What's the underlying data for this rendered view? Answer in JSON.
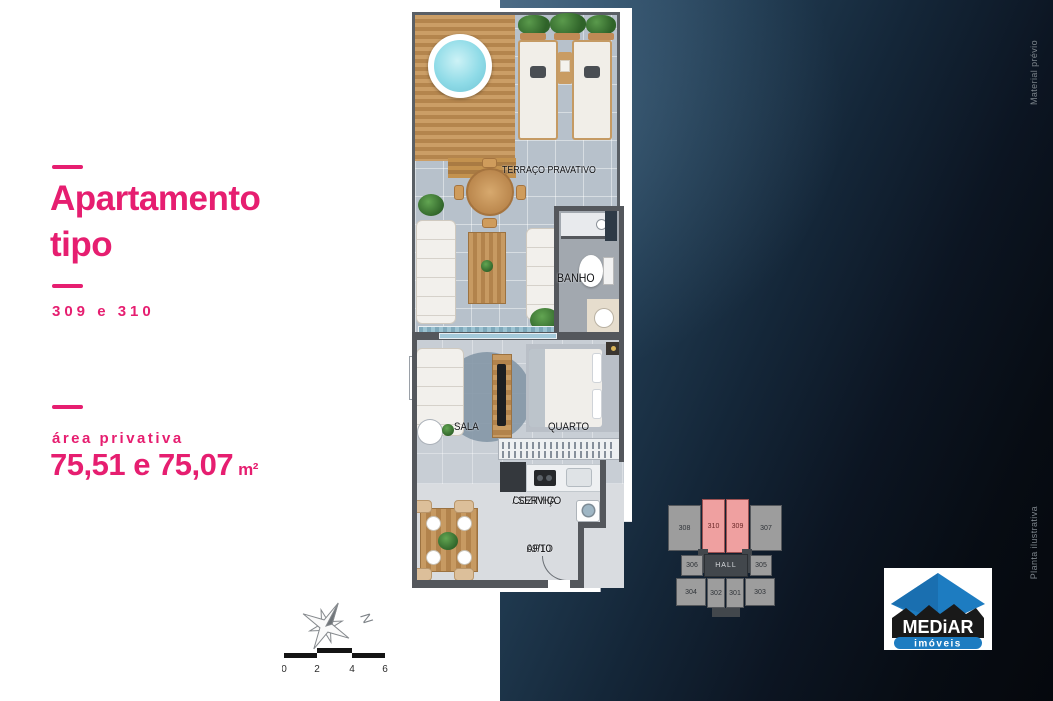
{
  "colors": {
    "accent_pink": "#e61e70",
    "dark_panel_from": "#44627c",
    "dark_panel_to": "#05080d",
    "keyplan_highlight": "#efa0a0",
    "logo_blue": "#1d7cc1"
  },
  "left_panel": {
    "title_line1": "Apartamento",
    "title_line2": "tipo",
    "units_label": "309 e 310",
    "area_label": "área privativa",
    "area_value": "75,51 e 75,07",
    "area_unit": "m²"
  },
  "floor_plan": {
    "labels": {
      "terrace": "TERRAÇO PRAVATIVO",
      "bath": "BANHO",
      "living": "SALA",
      "bedroom": "QUARTO",
      "kitchen_line1": "COZINHA",
      "kitchen_line2": "/ SERVIÇO",
      "apto_line1": "APTO",
      "apto_line2": "09/10"
    }
  },
  "compass": {
    "north": "N"
  },
  "scale_bar": {
    "ticks": [
      "0",
      "2",
      "4",
      "6"
    ]
  },
  "key_plan": {
    "top_row": [
      "308",
      "310",
      "309",
      "307"
    ],
    "mid_left": "306",
    "hall": "HALL",
    "mid_right": "305",
    "bottom_row": [
      "304",
      "302",
      "301",
      "303"
    ],
    "highlighted_units": [
      "310",
      "309"
    ]
  },
  "logo": {
    "brand": "MEDiAR",
    "tagline": "imóveis"
  },
  "watermarks": {
    "top": "Material prévio",
    "bottom": "Planta ilustrativa"
  }
}
